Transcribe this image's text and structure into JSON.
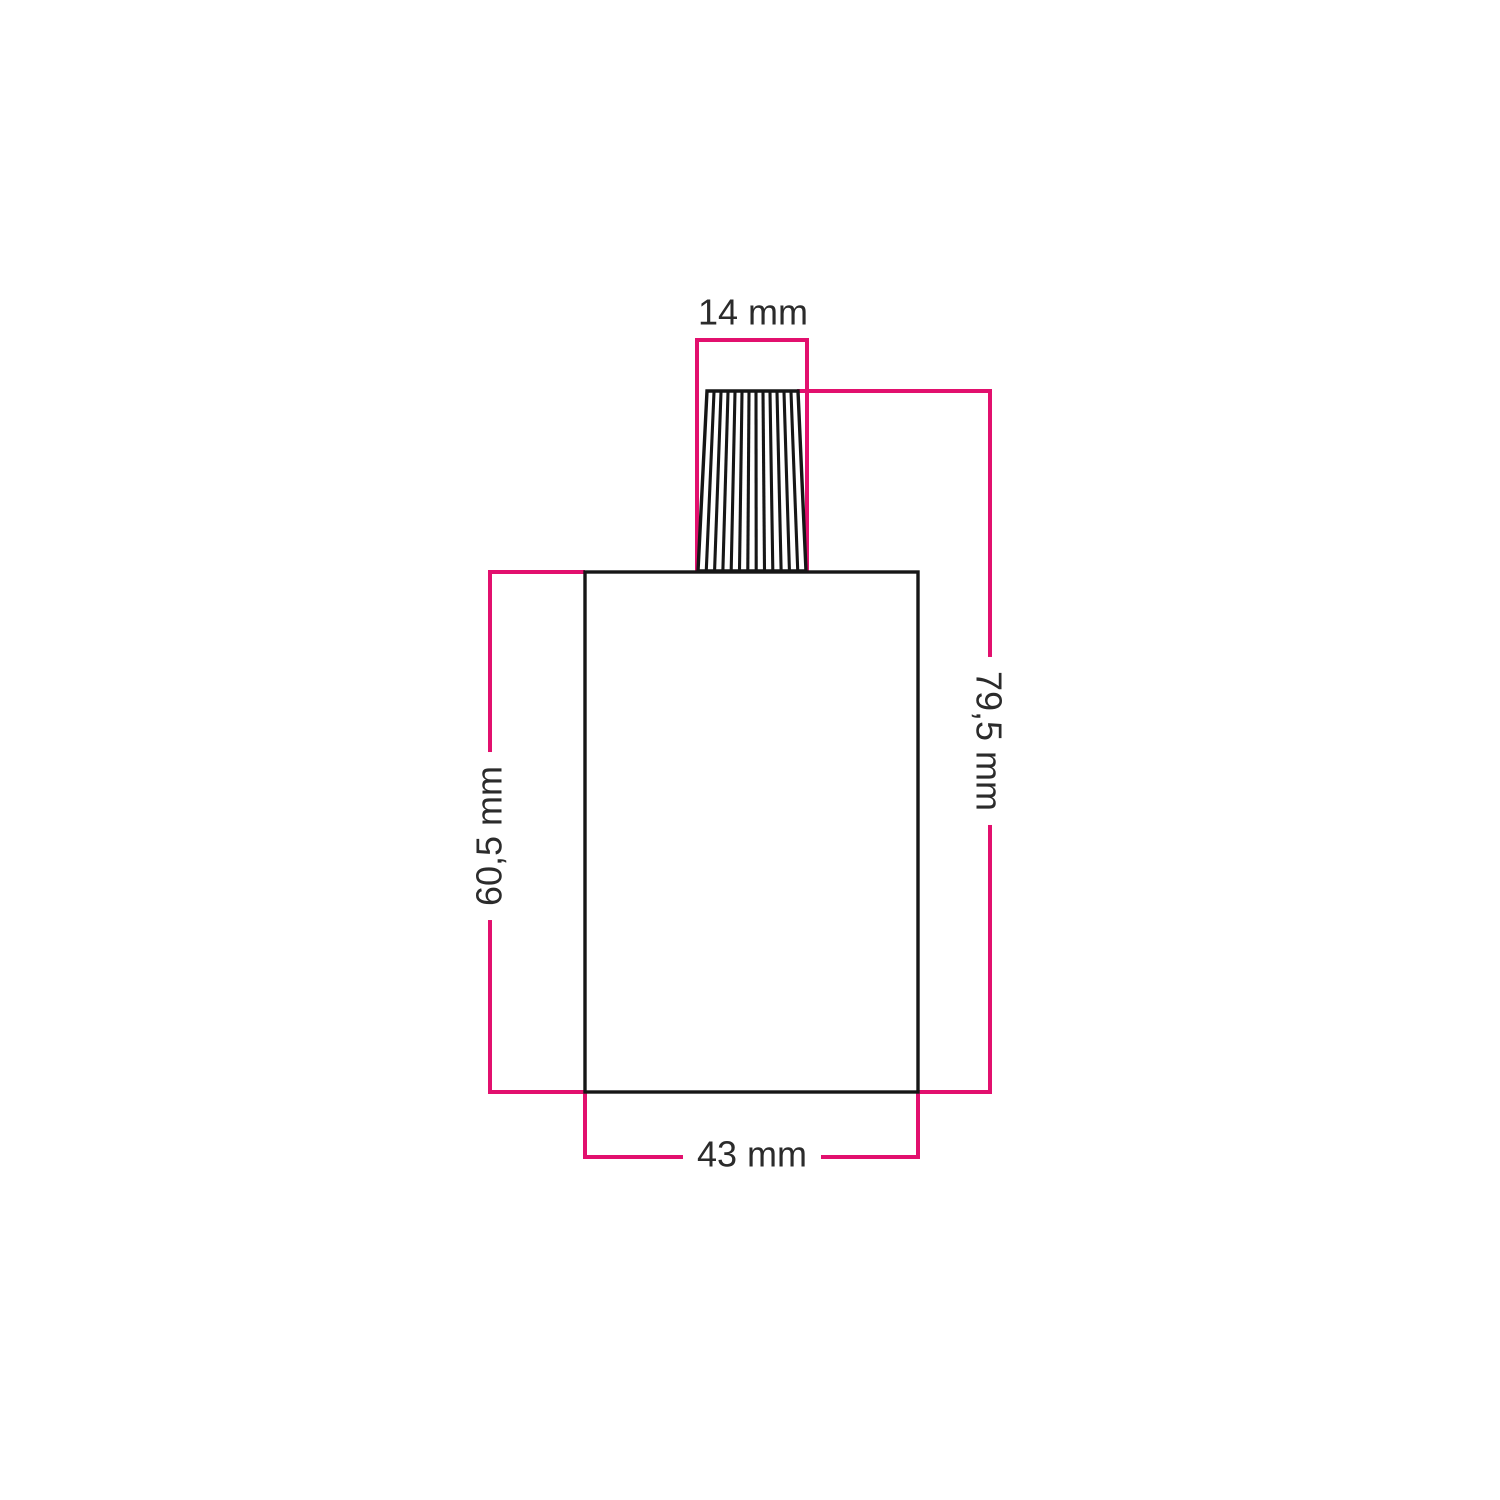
{
  "diagram": {
    "type": "technical dimension drawing",
    "figure": "lamp holder body with ribbed conical cable grip",
    "measurements": {
      "top": {
        "label": "14 mm",
        "value": 14,
        "unit": "mm",
        "measures": "cable grip width"
      },
      "right": {
        "label": "79,5 mm",
        "value": 79.5,
        "unit": "mm",
        "measures": "overall height"
      },
      "left": {
        "label": "60,5 mm",
        "value": 60.5,
        "unit": "mm",
        "measures": "body height"
      },
      "bottom": {
        "label": "43 mm",
        "value": 43,
        "unit": "mm",
        "measures": "body width"
      }
    },
    "colors": {
      "dimension_lines": "#e2106e",
      "outline": "#161616",
      "text": "#2b2b2b",
      "background": "#ffffff"
    }
  }
}
